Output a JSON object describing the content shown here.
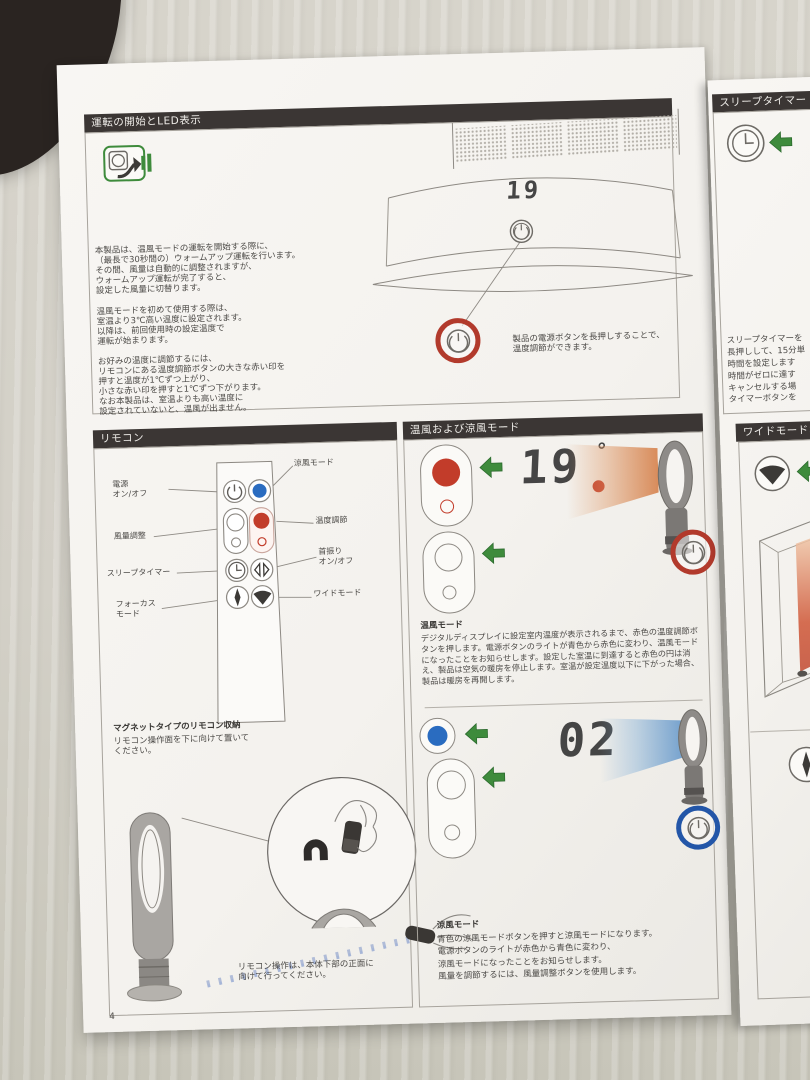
{
  "photo": {
    "page_number": "4"
  },
  "colors": {
    "header_bg": "#3b3634",
    "paper": "#f5f3f0",
    "accent_green": "#3e8b3c",
    "accent_red": "#bb3a2b",
    "accent_blue": "#2a6cc0",
    "warm_air": "#d9783f",
    "cool_air": "#6e9fd1"
  },
  "icons": {
    "plug_in": "plug-in-icon",
    "power": "power-icon",
    "cool_mode_button": "cool-mode-dot-icon",
    "airflow_buttons": "airflow-buttons-icon",
    "temperature_buttons": "temperature-buttons-icon",
    "clock": "clock-icon",
    "oscillation": "oscillation-icon",
    "focus": "focus-icon",
    "wide": "wide-icon",
    "magnet": "magnet-icon",
    "green_arrow": "green-arrow-icon"
  },
  "operation": {
    "title": "運転の開始とLED表示",
    "para1": "本製品は、温風モードの運転を開始する際に、\n（最長で30秒間の）ウォームアップ運転を行います。\nその間、風量は自動的に調整されますが、\nウォームアップ運転が完了すると、\n設定した風量に切替ります。",
    "para2": "温風モードを初めて使用する際は、\n室温より3℃高い温度に設定されます。\n以降は、前回使用時の設定温度で\n運転が始まります。",
    "para3": "お好みの温度に調節するには、\nリモコンにある温度調節ボタンの大きな赤い印を\n押すと温度が1℃ずつ上がり、\n小さな赤い印を押すと1℃ずつ下がります。\nなお本製品は、室温よりも高い温度に\n設定されていないと、温風が出ません。",
    "display": "19",
    "callout": "製品の電源ボタンを長押しすることで、\n温度調節ができます。"
  },
  "remote": {
    "title": "リモコン",
    "label_power": "電源\nオン/オフ",
    "label_cool": "涼風モード",
    "label_airflow": "風量調整",
    "label_temp": "温度調節",
    "label_sleep": "スリープタイマー",
    "label_osc": "首振り\nオン/オフ",
    "label_focus": "フォーカス\nモード",
    "label_wide": "ワイドモード",
    "magnet_title": "マグネットタイプのリモコン収納",
    "magnet_text": "リモコン操作面を下に向けて置いて\nください。",
    "pointing_note": "リモコン操作は、本体下部の正面に\n向けて行ってください。"
  },
  "modes": {
    "title": "温風および涼風モード",
    "heat": {
      "heading": "温風モード",
      "display": "19",
      "degree": "°",
      "body": "デジタルディスプレイに設定室内温度が表示されるまで、赤色の温度調節ボタンを押します。電源ボタンのライトが青色から赤色に変わり、温風モードになったことをお知らせします。設定した室温に到達すると赤色の円は消え、製品は空気の暖房を停止します。室温が設定温度以下に下がった場合、製品は暖房を再開します。"
    },
    "cool": {
      "heading": "涼風モード",
      "display": "02",
      "body": "青色の涼風モードボタンを押すと涼風モードになります。\n電源ボタンのライトが赤色から青色に変わり、\n涼風モードになったことをお知らせします。\n風量を調節するには、風量調整ボタンを使用します。"
    }
  },
  "sleep_timer": {
    "title": "スリープタイマー",
    "body": "スリープタイマーを\n長押しして、15分単\n時間を設定します\n時間がゼロに達す\nキャンセルする場\nタイマーボタンを"
  },
  "wide_mode": {
    "title": "ワイドモードお"
  }
}
